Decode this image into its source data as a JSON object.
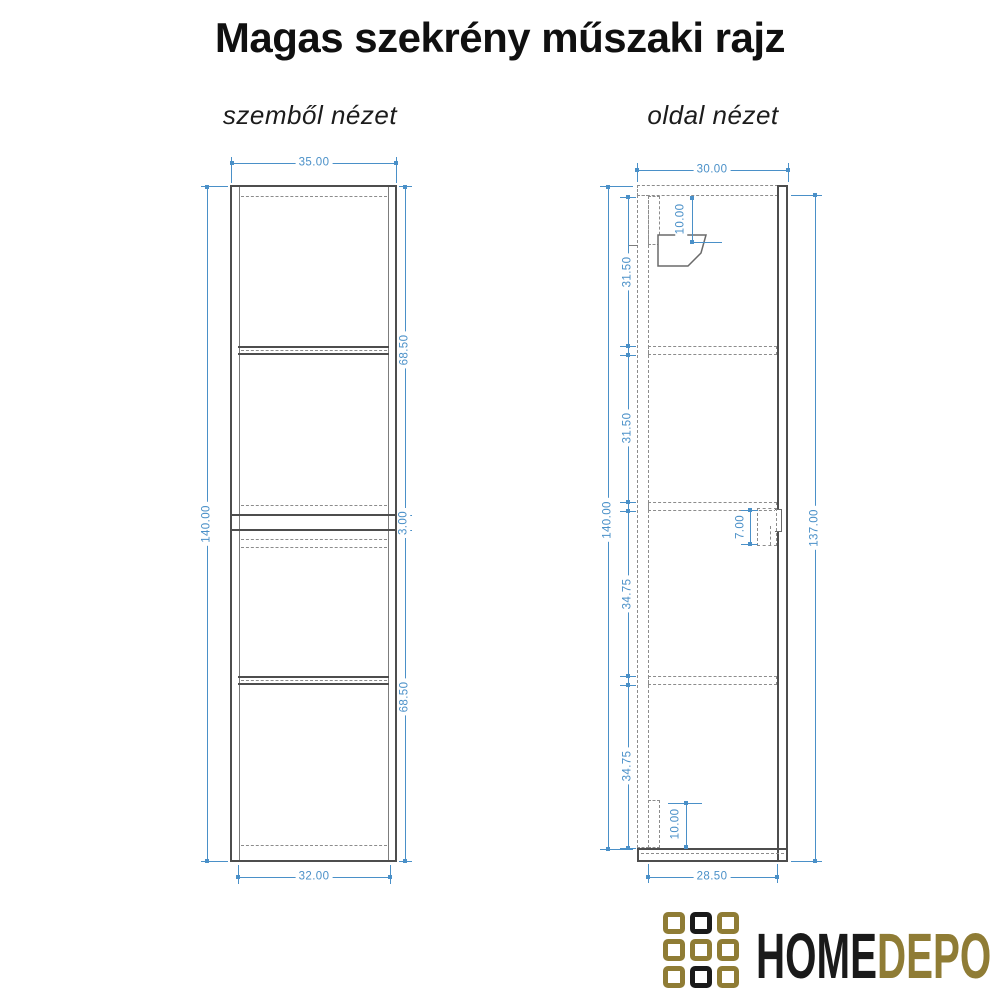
{
  "title": "Magas szekrény műszaki rajz",
  "views": {
    "front": {
      "label": "szemből nézet",
      "dims": {
        "width_top": "35.00",
        "height_total": "140.00",
        "upper_section": "68.50",
        "gap": "3.00",
        "lower_section": "68.50",
        "width_bottom": "32.00"
      }
    },
    "side": {
      "label": "oldal nézet",
      "dims": {
        "depth_top": "30.00",
        "height_total": "140.00",
        "section_1": "31.50",
        "section_2": "31.50",
        "section_3": "34.75",
        "section_4": "34.75",
        "height_right": "137.00",
        "depth_bottom": "28.50",
        "bracket_offset": "10.00",
        "rail_height": "10.00",
        "plate_height": "7.00"
      }
    }
  },
  "logo": {
    "text_primary": "HOME",
    "text_secondary": "DEPO"
  },
  "colors": {
    "dimension_blue": "#4a90c8",
    "drawing_line": "#4d4d4d",
    "dashed_line": "#8c8c8c",
    "logo_gold": "#8f7c35",
    "logo_black": "#1a1a1a"
  }
}
